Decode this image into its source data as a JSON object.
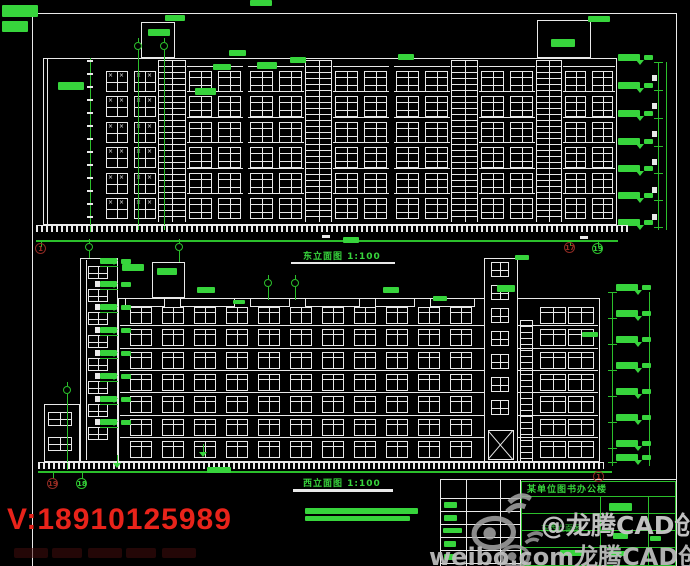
{
  "colors": {
    "line_green": "#2bbf2b",
    "blob_green": "#37d43c",
    "cad_white": "#e9e9e9",
    "bubble_red": "#8f2a23",
    "watermark_red": "#e8231a",
    "watermark_gray": "#c6c6c6",
    "background": "#000000"
  },
  "titles": {
    "top_elevation": "东立面图 1:100",
    "bottom_elevation": "西立面图 1:100"
  },
  "title_block": {
    "project": "某单位图书办公楼",
    "drawing_name": "东西立面图"
  },
  "watermarks": {
    "phone": "V:18910125989",
    "weibo_handle": "@龙腾CAD创作室",
    "weibo_url": "weibo.com龙腾CAD创作室"
  },
  "grid_bubbles": [
    {
      "label": "1",
      "x": 41,
      "y": 249,
      "color": "red"
    },
    {
      "label": "17",
      "x": 570,
      "y": 248,
      "color": "red"
    },
    {
      "label": "19",
      "x": 598,
      "y": 249,
      "color": "green"
    },
    {
      "label": "19",
      "x": 53,
      "y": 484,
      "color": "red"
    },
    {
      "label": "18",
      "x": 82,
      "y": 484,
      "color": "green"
    },
    {
      "label": "1",
      "x": 599,
      "y": 477,
      "color": "red"
    }
  ],
  "scale_bars": [
    [
      305,
      508,
      113,
      6
    ],
    [
      305,
      516,
      105,
      5
    ]
  ],
  "faint_marks": [
    [
      14,
      548,
      34,
      10
    ],
    [
      52,
      548,
      30,
      10
    ],
    [
      88,
      548,
      34,
      10
    ],
    [
      126,
      548,
      30,
      10
    ],
    [
      162,
      548,
      34,
      10
    ]
  ],
  "drawing": {
    "frame": {
      "x1": 32,
      "y1": 13,
      "x2": 676,
      "y2": 566
    },
    "top": {
      "facade": [
        43,
        58,
        574,
        167
      ],
      "inner_vlines": [
        [
          47,
          58,
          167
        ]
      ],
      "floors": {
        "y0": 71,
        "step": 25.4,
        "h": 21,
        "n": 6
      },
      "segments": [
        [
          "xpair",
          105,
          52
        ],
        [
          "ladder",
          158,
          28
        ],
        [
          "grid",
          187,
          56
        ],
        [
          "grid",
          248,
          56
        ],
        [
          "ladder",
          305,
          27
        ],
        [
          "grid",
          333,
          56
        ],
        [
          "grid",
          394,
          56
        ],
        [
          "ladder",
          451,
          27
        ],
        [
          "grid",
          479,
          56
        ],
        [
          "ladder",
          536,
          26
        ],
        [
          "grid",
          563,
          52
        ]
      ],
      "bulkheads": [
        [
          141,
          22,
          34,
          36
        ],
        [
          537,
          20,
          54,
          38
        ]
      ],
      "axis_symbols": [
        [
          138,
          42,
          230
        ],
        [
          164,
          42,
          230
        ],
        [
          89,
          243,
          258
        ],
        [
          179,
          243,
          262
        ]
      ],
      "dim_left": {
        "x": 90,
        "y1": 58,
        "y2": 232,
        "tick_ys": [
          60,
          73,
          86,
          99,
          112,
          125,
          138,
          151,
          164,
          177,
          190,
          203,
          216
        ]
      },
      "chain": {
        "lines": [
          [
            658,
            62,
            168
          ],
          [
            666,
            62,
            168
          ]
        ],
        "levels": [
          62,
          90,
          118,
          146,
          173,
          200,
          227
        ],
        "marker_x": 618
      },
      "hatch": [
        36,
        225,
        592,
        7
      ],
      "baseline": [
        36,
        240,
        582,
        2
      ],
      "white_dashes": [
        [
          322,
          235,
          8,
          3
        ],
        [
          580,
          236,
          8,
          3
        ],
        [
          652,
          75,
          5,
          6
        ],
        [
          652,
          103,
          5,
          6
        ],
        [
          652,
          131,
          5,
          6
        ],
        [
          652,
          159,
          5,
          6
        ],
        [
          652,
          187,
          5,
          6
        ],
        [
          652,
          214,
          5,
          6
        ]
      ],
      "blobs": [
        [
          2,
          5,
          36,
          12
        ],
        [
          2,
          21,
          26,
          11
        ],
        [
          250,
          0,
          22,
          6
        ],
        [
          58,
          82,
          26,
          8
        ],
        [
          148,
          29,
          22,
          7
        ],
        [
          165,
          15,
          20,
          6
        ],
        [
          195,
          88,
          21,
          7
        ],
        [
          213,
          64,
          18,
          6
        ],
        [
          229,
          50,
          17,
          6
        ],
        [
          257,
          62,
          20,
          7
        ],
        [
          290,
          57,
          16,
          6
        ],
        [
          398,
          54,
          16,
          6
        ],
        [
          551,
          39,
          24,
          8
        ],
        [
          588,
          16,
          22,
          6
        ]
      ],
      "underline": [
        291,
        262,
        104,
        2
      ],
      "bubble_stubs": [
        [
          41,
          241,
          6
        ],
        [
          570,
          240,
          6
        ],
        [
          598,
          240,
          7
        ]
      ]
    },
    "bottom": {
      "facade": [
        118,
        298,
        482,
        164
      ],
      "floors": {
        "y0": 307,
        "step": 22.3,
        "h": 17,
        "n": 7
      },
      "bay_xs": [
        130,
        162,
        194,
        226,
        258,
        290,
        322,
        354,
        386,
        418,
        450
      ],
      "bay_w": 22,
      "right_windows_xs": [
        540,
        568
      ],
      "right_window_w": 26,
      "ladder": [
        520,
        320,
        13,
        142
      ],
      "parapet_boxes": [
        [
          125,
          298,
          40,
          9
        ],
        [
          180,
          298,
          55,
          9
        ],
        [
          250,
          298,
          40,
          9
        ],
        [
          305,
          298,
          55,
          9
        ],
        [
          375,
          298,
          40,
          9
        ],
        [
          430,
          298,
          45,
          9
        ]
      ],
      "left_tower": [
        80,
        258,
        38,
        204
      ],
      "left_tower_vline": 86,
      "left_tower_win": {
        "x": 88,
        "w": 20,
        "h": 13,
        "ys": [
          266,
          289,
          312,
          335,
          358,
          381,
          404,
          427
        ]
      },
      "right_tower": [
        484,
        258,
        34,
        204
      ],
      "right_tower_win": {
        "x": 491,
        "w": 18,
        "h": 15,
        "ys": [
          262,
          285,
          308,
          331,
          354,
          377,
          400
        ]
      },
      "door": [
        488,
        430,
        26,
        30
      ],
      "annex": [
        44,
        404,
        36,
        58
      ],
      "annex_windows": [
        [
          48,
          412,
          24,
          14
        ],
        [
          48,
          437,
          24,
          14
        ]
      ],
      "bulkhead": [
        152,
        262,
        33,
        36
      ],
      "bulkhead_blob": [
        157,
        268,
        20,
        7
      ],
      "axis_symbols": [
        [
          268,
          279,
          300
        ],
        [
          295,
          279,
          300
        ],
        [
          67,
          386,
          470
        ]
      ],
      "left_markers": {
        "x": 100,
        "ys": [
          266,
          289,
          312,
          335,
          358,
          381,
          404,
          427
        ]
      },
      "chain": {
        "lines": [
          [
            612,
            292,
            174
          ],
          [
            649,
            292,
            174
          ]
        ],
        "levels": [
          292,
          318,
          344,
          370,
          396,
          422,
          448,
          462
        ],
        "marker_x": 616
      },
      "hatch": [
        38,
        462,
        566,
        7
      ],
      "baseline": [
        38,
        471,
        574,
        2
      ],
      "ground_markers": [
        [
          117,
          463
        ],
        [
          203,
          452
        ]
      ],
      "bubble_stubs": [
        [
          53,
          472,
          7
        ],
        [
          82,
          472,
          7
        ]
      ],
      "blobs": [
        [
          122,
          264,
          22,
          7
        ],
        [
          197,
          287,
          18,
          6
        ],
        [
          233,
          300,
          12,
          4
        ],
        [
          383,
          287,
          16,
          6
        ],
        [
          433,
          296,
          14,
          5
        ],
        [
          497,
          285,
          18,
          7
        ],
        [
          515,
          255,
          14,
          5
        ],
        [
          582,
          332,
          16,
          5
        ],
        [
          207,
          467,
          24,
          6
        ],
        [
          343,
          237,
          16,
          6
        ]
      ],
      "underline": [
        293,
        489,
        100,
        3
      ]
    },
    "titleblock": {
      "white_hlines": [
        [
          440,
          479,
          236
        ],
        [
          440,
          498,
          80
        ],
        [
          440,
          511,
          80
        ],
        [
          440,
          524,
          80
        ],
        [
          440,
          537,
          80
        ],
        [
          440,
          550,
          80
        ],
        [
          440,
          563,
          80
        ]
      ],
      "white_vlines": [
        [
          440,
          479,
          87
        ],
        [
          466,
          479,
          87
        ],
        [
          500,
          479,
          87
        ],
        [
          520,
          479,
          87
        ]
      ],
      "green_box": [
        521,
        481,
        155,
        85
      ],
      "green_hlines": [
        [
          521,
          496,
          155
        ],
        [
          521,
          513,
          155
        ],
        [
          521,
          530,
          155
        ],
        [
          521,
          547,
          155
        ]
      ],
      "green_vlines": [
        [
          600,
          496,
          70
        ],
        [
          648,
          496,
          70
        ]
      ],
      "blobs": [
        [
          444,
          502,
          13,
          6
        ],
        [
          444,
          515,
          13,
          6
        ],
        [
          443,
          528,
          19,
          5
        ],
        [
          444,
          541,
          12,
          6
        ],
        [
          444,
          554,
          12,
          6
        ],
        [
          609,
          503,
          23,
          8
        ],
        [
          613,
          533,
          15,
          6
        ],
        [
          650,
          536,
          11,
          5
        ],
        [
          560,
          550,
          24,
          6
        ],
        [
          609,
          551,
          16,
          5
        ]
      ]
    }
  }
}
